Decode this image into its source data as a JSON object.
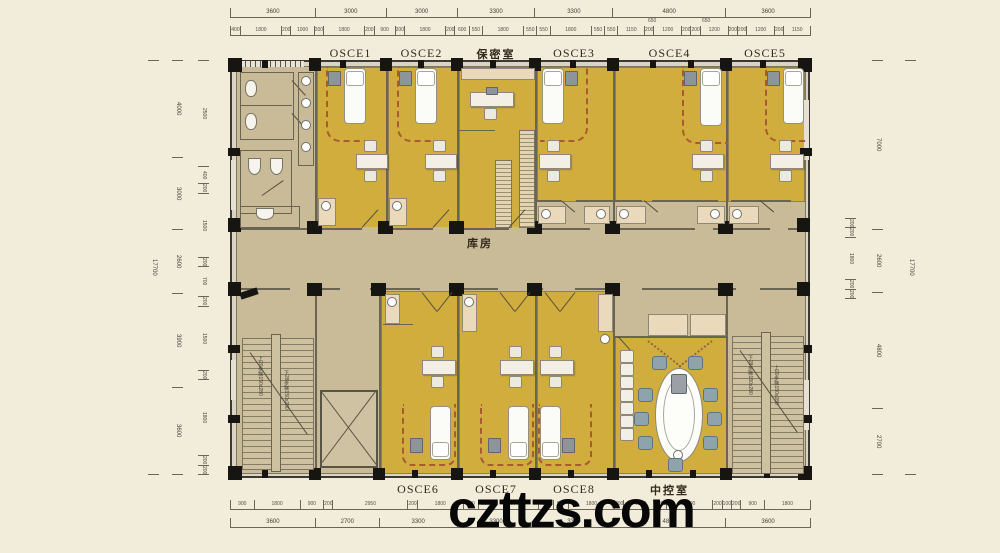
{
  "watermark": "czttzs.com",
  "plan": {
    "center_label": "库房",
    "top_rooms": [
      {
        "label": "OSCE1"
      },
      {
        "label": "OSCE2"
      },
      {
        "label": "保密室"
      },
      {
        "label": "OSCE3"
      },
      {
        "label": "OSCE4"
      },
      {
        "label": "OSCE5"
      }
    ],
    "bottom_rooms": [
      {
        "label": "OSCE6"
      },
      {
        "label": "OSCE7"
      },
      {
        "label": "OSCE8"
      },
      {
        "label": "中控室"
      }
    ],
    "stair_left_up": "上20步梯150x280",
    "stair_left_down": "下28步梯150x280",
    "stair_right_up": "上20步梯150x280",
    "stair_right_down": "下28步梯150x280"
  },
  "dimensions": {
    "top_main": [
      "3600",
      "3000",
      "3000",
      "3300",
      "3300",
      "4800",
      "3600"
    ],
    "top_detail": [
      "400",
      "1800",
      "200",
      "1000",
      "200",
      "1800",
      "200",
      "900",
      "200",
      "1800",
      "200",
      "600",
      "550",
      "1800",
      "550",
      "550",
      "1800",
      "550",
      "550",
      "1150",
      "200",
      "1200",
      "200",
      "200",
      "1200",
      "200",
      "200",
      "1200",
      "200",
      "1150"
    ],
    "top_sub": [
      "650",
      "650"
    ],
    "bottom_main": [
      "3600",
      "2700",
      "3300",
      "3300",
      "3300",
      "4800",
      "3600"
    ],
    "bottom_detail": [
      "900",
      "1800",
      "900",
      "200",
      "2950",
      "200",
      "1800",
      "550",
      "550",
      "1800",
      "550",
      "550",
      "1800",
      "200",
      "1300",
      "200",
      "1800",
      "200",
      "100",
      "200",
      "900",
      "1800"
    ],
    "left_total": "17700",
    "left_main": [
      "4000",
      "3000",
      "2600",
      "3900",
      "3600"
    ],
    "left_detail": [
      "2500",
      "400",
      "200",
      "1500",
      "200",
      "700",
      "200",
      "1500",
      "200",
      "1800",
      "200",
      "200"
    ],
    "right_total": "17700",
    "right_main": [
      "7000",
      "2600",
      "4800",
      "2700"
    ],
    "right_detail": [
      "200",
      "200",
      "1800",
      "200",
      "200"
    ]
  },
  "colors": {
    "room_yellow": "#d1ad3e",
    "corridor_tan": "#c9ba98",
    "wall": "#3b3931",
    "paper": "#f2ecdb"
  }
}
